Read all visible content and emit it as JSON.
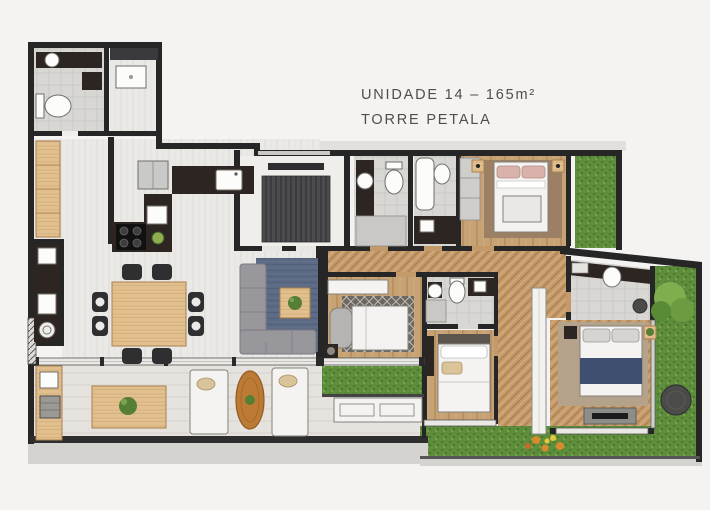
{
  "title": {
    "line1": "UNIDADE 14 – 165m²",
    "line2": "TORRE PETALA"
  },
  "palette": {
    "background": "#f4f3f1",
    "wall": "#262626",
    "floor_light": "#ebe9e5",
    "floor_herringbone": "#c49a6b",
    "floor_plank": "#c7a274",
    "floor_tile": "#d8d7d4",
    "terrace_floor": "#e6e3de",
    "counter_dark": "#2d2522",
    "rug_blue": "#5c6a85",
    "rug_master": "#b4a28a",
    "bed_throw_navy": "#3f4f6f",
    "grass": "#5e8e3c",
    "furniture_wood": "#e2bf8e",
    "plant_green": "#567f36",
    "text": "#4f4e4c"
  }
}
